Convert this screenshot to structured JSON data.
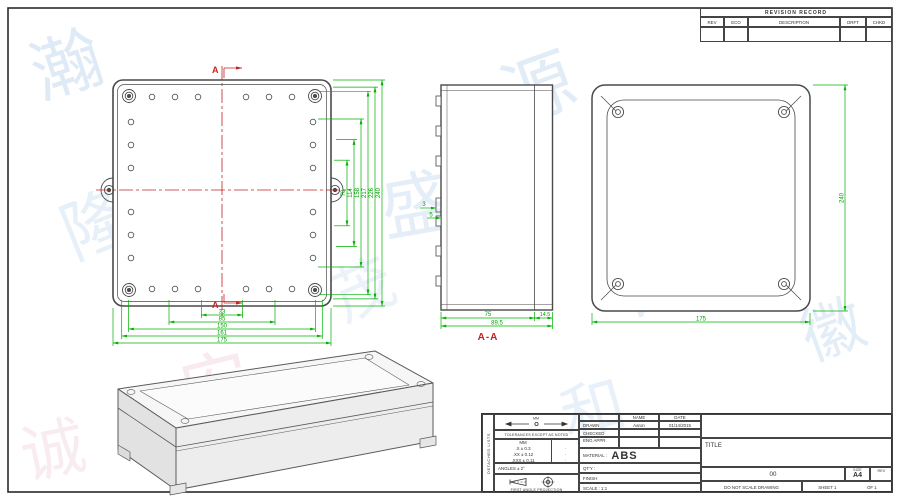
{
  "revision_table": {
    "title": "REVISION RECORD",
    "col_rev": "REV",
    "col_eco": "ECO",
    "col_description": "DESCRIPTION",
    "col_drft": "DRFT",
    "col_chkd": "CHKD"
  },
  "front_view": {
    "marker_top": "A",
    "marker_bottom": "A",
    "dims_vertical": [
      "70",
      "114",
      "158",
      "217",
      "226",
      "240"
    ],
    "dims_horizontal": [
      "33",
      "85",
      "150",
      "161",
      "175"
    ]
  },
  "section_view": {
    "label": "A-A",
    "dim_body": "75",
    "dim_total": "89.5",
    "dim_lid": "14.5",
    "dim_wall": "3",
    "dim_step": "5"
  },
  "back_view": {
    "dim_height": "240",
    "dim_width": "175"
  },
  "title_block": {
    "side_label": "DETACHED LISTS",
    "units_label": "MM",
    "tolerance_heading": "TOLERANCES EXCEPT AS NOTED",
    "tolerance_col": "MM",
    "tolerances": [
      ".X ± 0.3",
      ".XX ± 0.12",
      ".XXX ± 0.11"
    ],
    "tolerance_marks": [
      "·",
      "·",
      "·"
    ],
    "angles_label": "ANGLES ± 2°",
    "projection_label": "FIRST ANGLE PROJECTION",
    "name_header": "NAME",
    "date_header": "DATE",
    "drawn_label": "DRAWN",
    "drawn_name": "Aaron",
    "drawn_date": "01/14/2015",
    "checked_label": "CHECKED",
    "eng_appr_label": "ENG APPR.",
    "material_label": "MATERIAL :",
    "material_value": "ABS",
    "qty_label": "QT'Y :",
    "finish_label": "FINISH",
    "scale_label": "SCALE : 1:1",
    "title_label": "TITLE",
    "drawing_number": "00",
    "size_label": "SIZE",
    "size_value": "A4",
    "rev_label": "REV",
    "do_not_scale": "DO NOT SCALE DRAWING",
    "sheet_label": "SHEET 1",
    "of_label": "OF 1"
  },
  "colors": {
    "dimension_green": "#00b000",
    "centerline_red": "#c42222",
    "line_grey": "#4a4a4a"
  },
  "watermark": {
    "glyphs": [
      "瀚",
      "鑫",
      "源",
      "泰",
      "隆",
      "盛",
      "昌",
      "安",
      "和",
      "徽",
      "诚",
      "茂"
    ]
  }
}
